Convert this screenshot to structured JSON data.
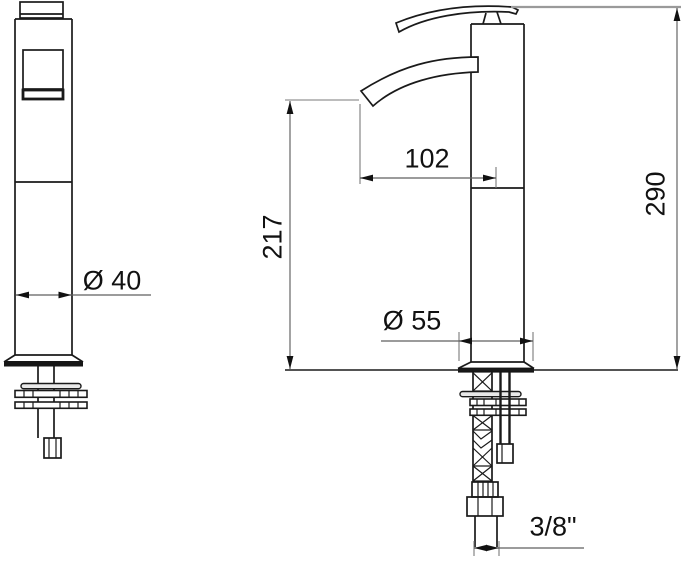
{
  "dimensions": {
    "front_view": {
      "body_diameter": "Ø 40"
    },
    "side_view": {
      "spout_reach": "102",
      "spout_height": "217",
      "overall_height": "290",
      "base_diameter": "Ø 55",
      "supply_connection": "3/8\""
    }
  },
  "colors": {
    "object_line": "#1a1a1a",
    "dimension_line": "#5f5f5f",
    "extension_line": "#9a9a9a",
    "background": "#ffffff",
    "text": "#111111"
  }
}
